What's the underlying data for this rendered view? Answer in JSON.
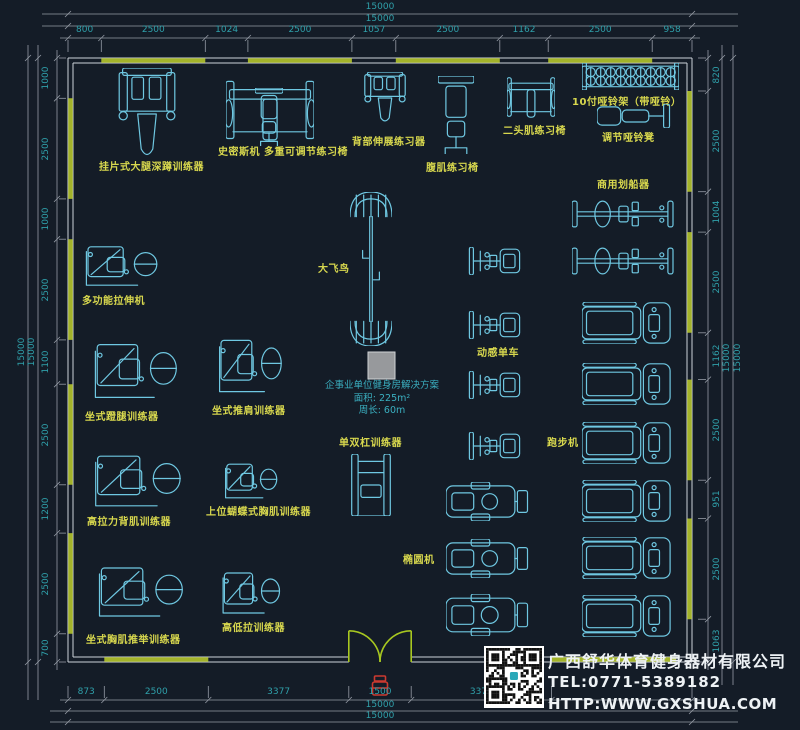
{
  "colors": {
    "background": "#141c27",
    "equipment_stroke": "#6fc8e2",
    "label_yellow": "#d8d84e",
    "dimension_teal": "#2fa0aa",
    "dim_line_gray": "#959ca6",
    "wall_green": "#a3b32a",
    "wall_line": "#ccd2d8",
    "door_green": "#a8c820",
    "note_cyan": "#3aafc0",
    "company_white": "#eef2f5",
    "marker_red": "#cc3a30",
    "gray_square": "#97999c"
  },
  "dimensions": {
    "overall_label": "15000",
    "top": [
      "800",
      "2500",
      "1024",
      "2500",
      "1057",
      "2500",
      "1162",
      "2500",
      "958"
    ],
    "left": [
      "1000",
      "2500",
      "1000",
      "2500",
      "1100",
      "2500",
      "1200",
      "2500",
      "700"
    ],
    "right": [
      "820",
      "2500",
      "1004",
      "2500",
      "1162",
      "2500",
      "951",
      "2500",
      "1063"
    ],
    "bottom": [
      "873",
      "2500",
      "3377",
      "1500",
      "3372"
    ]
  },
  "note": {
    "line1": "企事业单位健身房解决方案",
    "line2": "面积: 225m²",
    "line3": "周长: 60m"
  },
  "company": {
    "name": "广西舒华体育健身器材有限公司",
    "tel": "TEL:0771-5389182",
    "web": "HTTP:WWW.GXSHUA.COM"
  },
  "equipment": [
    {
      "name": "hack-squat-trainer",
      "label": "挂片式大腿深蹲训练器",
      "glyph": "machine-v",
      "box": [
        118,
        68,
        58,
        92
      ],
      "label_pos": [
        99,
        158
      ]
    },
    {
      "name": "smith-machine",
      "label": "史密斯机",
      "glyph": "frame-h",
      "box": [
        226,
        76,
        88,
        68
      ],
      "label_pos": [
        218,
        143
      ]
    },
    {
      "name": "adjustable-bench",
      "label": "多重可调节练习椅",
      "glyph": "bench-v",
      "box": [
        255,
        88,
        28,
        58
      ],
      "label_pos": [
        264,
        143
      ]
    },
    {
      "name": "back-extension",
      "label": "背部伸展练习器",
      "glyph": "machine-v",
      "box": [
        364,
        72,
        42,
        52
      ],
      "label_pos": [
        352,
        133
      ]
    },
    {
      "name": "ab-bench",
      "label": "腹肌练习椅",
      "glyph": "bench-v",
      "box": [
        438,
        76,
        36,
        78
      ],
      "label_pos": [
        426,
        159
      ]
    },
    {
      "name": "biceps-bench",
      "label": "二头肌练习椅",
      "glyph": "frame-h",
      "box": [
        507,
        74,
        48,
        46
      ],
      "label_pos": [
        503,
        122
      ]
    },
    {
      "name": "dumbbell-rack",
      "label": "10付哑铃架（带哑铃）",
      "glyph": "rack-h",
      "box": [
        582,
        63,
        97,
        27
      ],
      "label_pos": [
        572,
        93
      ]
    },
    {
      "name": "dumbbell-bench",
      "label": "调节哑铃凳",
      "glyph": "bench-h",
      "box": [
        597,
        104,
        74,
        24
      ],
      "label_pos": [
        602,
        129
      ]
    },
    {
      "name": "rowing-machine-1",
      "label": "商用划船器",
      "glyph": "rower",
      "box": [
        572,
        200,
        102,
        28
      ],
      "label_pos": [
        597,
        176
      ]
    },
    {
      "name": "rowing-machine-2",
      "label": "",
      "glyph": "rower",
      "box": [
        572,
        247,
        102,
        28
      ],
      "label_pos": [
        0,
        0
      ]
    },
    {
      "name": "multi-stretch-machine",
      "label": "多功能拉伸机",
      "glyph": "machine-h",
      "box": [
        80,
        242,
        80,
        48
      ],
      "label_pos": [
        82,
        292
      ]
    },
    {
      "name": "cable-crossover",
      "label": "大飞鸟",
      "glyph": "crossover",
      "box": [
        350,
        192,
        42,
        154
      ],
      "label_pos": [
        318,
        260
      ]
    },
    {
      "name": "spin-bike-1",
      "label": "",
      "glyph": "bike",
      "box": [
        466,
        247,
        57,
        28
      ],
      "label_pos": [
        0,
        0
      ]
    },
    {
      "name": "spin-bike-2",
      "label": "动感单车",
      "glyph": "bike",
      "box": [
        466,
        311,
        57,
        28
      ],
      "label_pos": [
        477,
        344
      ]
    },
    {
      "name": "spin-bike-3",
      "label": "",
      "glyph": "bike",
      "box": [
        466,
        371,
        57,
        28
      ],
      "label_pos": [
        0,
        0
      ]
    },
    {
      "name": "spin-bike-4",
      "label": "",
      "glyph": "bike",
      "box": [
        466,
        432,
        57,
        28
      ],
      "label_pos": [
        0,
        0
      ]
    },
    {
      "name": "treadmill-1",
      "label": "",
      "glyph": "treadmill",
      "box": [
        582,
        302,
        89,
        42
      ],
      "label_pos": [
        0,
        0
      ]
    },
    {
      "name": "treadmill-2",
      "label": "",
      "glyph": "treadmill",
      "box": [
        582,
        363,
        89,
        42
      ],
      "label_pos": [
        0,
        0
      ]
    },
    {
      "name": "treadmill-3",
      "label": "跑步机",
      "glyph": "treadmill",
      "box": [
        582,
        422,
        89,
        42
      ],
      "label_pos": [
        547,
        434
      ]
    },
    {
      "name": "treadmill-4",
      "label": "",
      "glyph": "treadmill",
      "box": [
        582,
        480,
        89,
        42
      ],
      "label_pos": [
        0,
        0
      ]
    },
    {
      "name": "treadmill-5",
      "label": "",
      "glyph": "treadmill",
      "box": [
        582,
        537,
        89,
        42
      ],
      "label_pos": [
        0,
        0
      ]
    },
    {
      "name": "treadmill-6",
      "label": "",
      "glyph": "treadmill",
      "box": [
        582,
        595,
        89,
        42
      ],
      "label_pos": [
        0,
        0
      ]
    },
    {
      "name": "seated-leg-press",
      "label": "坐式蹬腿训练器",
      "glyph": "machine-h",
      "box": [
        88,
        338,
        92,
        66
      ],
      "label_pos": [
        85,
        408
      ]
    },
    {
      "name": "seated-shoulder-press",
      "label": "坐式推肩训练器",
      "glyph": "machine-h",
      "box": [
        214,
        334,
        70,
        64
      ],
      "label_pos": [
        212,
        402
      ]
    },
    {
      "name": "lat-pulldown",
      "label": "高拉力背肌训练器",
      "glyph": "machine-h",
      "box": [
        88,
        450,
        96,
        62
      ],
      "label_pos": [
        87,
        513
      ]
    },
    {
      "name": "pec-fly",
      "label": "上位蝴蝶式胸肌训练器",
      "glyph": "machine-h",
      "box": [
        221,
        460,
        58,
        42
      ],
      "label_pos": [
        206,
        503
      ]
    },
    {
      "name": "dip-station",
      "label": "单双杠训练器",
      "glyph": "station",
      "box": [
        348,
        454,
        46,
        62
      ],
      "label_pos": [
        339,
        434
      ]
    },
    {
      "name": "elliptical-1",
      "label": "",
      "glyph": "elliptical",
      "box": [
        446,
        482,
        84,
        39
      ],
      "label_pos": [
        0,
        0
      ]
    },
    {
      "name": "elliptical-2",
      "label": "椭圆机",
      "glyph": "elliptical",
      "box": [
        446,
        539,
        84,
        39
      ],
      "label_pos": [
        403,
        551
      ]
    },
    {
      "name": "elliptical-3",
      "label": "",
      "glyph": "elliptical",
      "box": [
        446,
        594,
        84,
        42
      ],
      "label_pos": [
        0,
        0
      ]
    },
    {
      "name": "seated-chest-press",
      "label": "坐式胸肌推举训练器",
      "glyph": "machine-h",
      "box": [
        92,
        562,
        94,
        60
      ],
      "label_pos": [
        86,
        631
      ]
    },
    {
      "name": "high-low-pulley",
      "label": "高低拉训练器",
      "glyph": "machine-h",
      "box": [
        218,
        568,
        64,
        50
      ],
      "label_pos": [
        222,
        619
      ]
    }
  ]
}
